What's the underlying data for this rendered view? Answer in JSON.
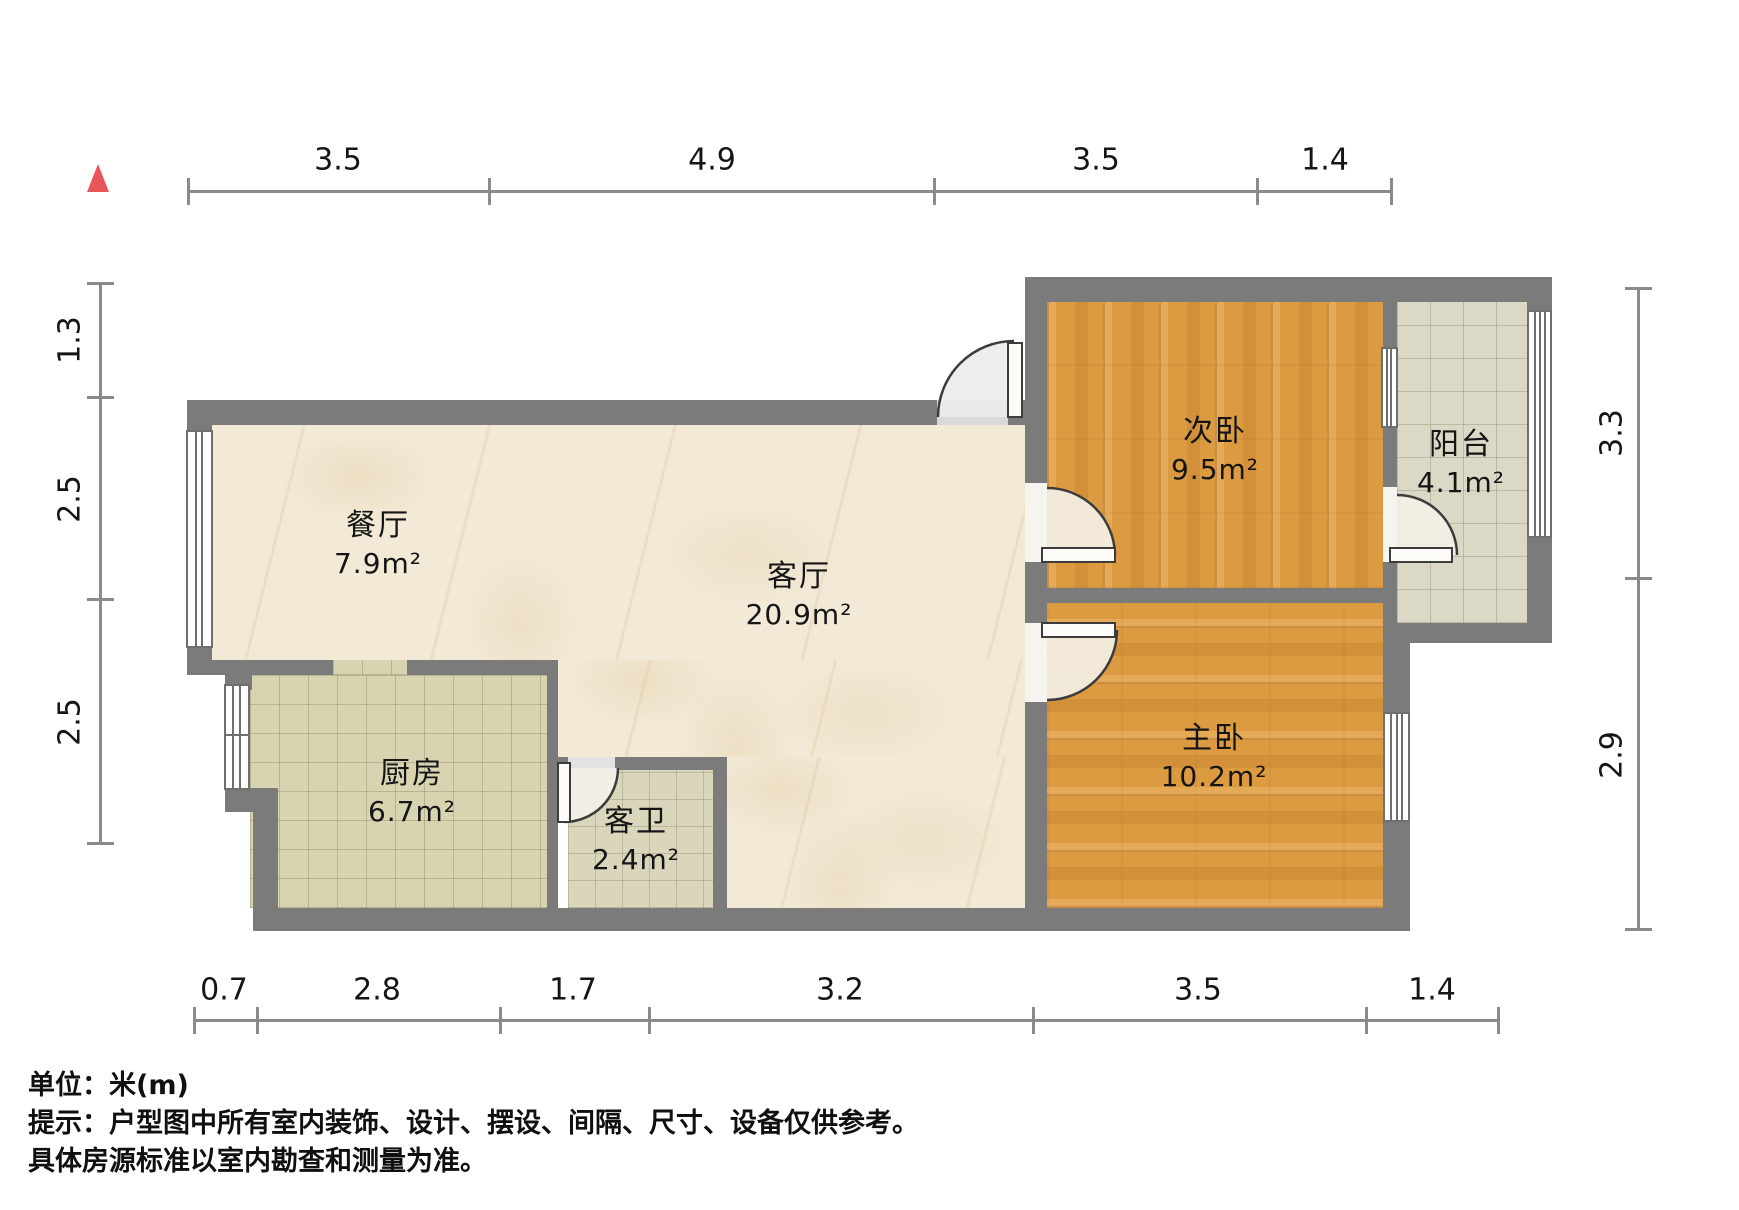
{
  "rooms": [
    {
      "id": "dining",
      "name": "餐厅",
      "area": "7.9m²"
    },
    {
      "id": "living",
      "name": "客厅",
      "area": "20.9m²"
    },
    {
      "id": "kitchen",
      "name": "厨房",
      "area": "6.7m²"
    },
    {
      "id": "bathroom",
      "name": "客卫",
      "area": "2.4m²"
    },
    {
      "id": "second-bedroom",
      "name": "次卧",
      "area": "9.5m²"
    },
    {
      "id": "master-bedroom",
      "name": "主卧",
      "area": "10.2m²"
    },
    {
      "id": "balcony",
      "name": "阳台",
      "area": "4.1m²"
    }
  ],
  "dimensions": {
    "top": [
      "3.5",
      "4.9",
      "3.5",
      "1.4"
    ],
    "bottom": [
      "0.7",
      "2.8",
      "1.7",
      "3.2",
      "3.5",
      "1.4"
    ],
    "left": [
      "1.3",
      "2.5",
      "2.5"
    ],
    "right": [
      "3.3",
      "2.9"
    ]
  },
  "footer": {
    "unit": "单位：米(m)",
    "tip": "提示：户型图中所有室内装饰、设计、摆设、间隔、尺寸、设备仅供参考。",
    "tip2": "具体房源标准以室内勘查和测量为准。"
  },
  "colors": {
    "wall": "#7b7b7b",
    "dim": "#8a8a8a",
    "ink": "#151515",
    "accent": "#e95659",
    "marble": "#f2e9d6",
    "wood": "#dd9b41",
    "tile": "#d8d4b2",
    "tile2": "#dad6bc",
    "tile3": "#dcd8c6"
  }
}
